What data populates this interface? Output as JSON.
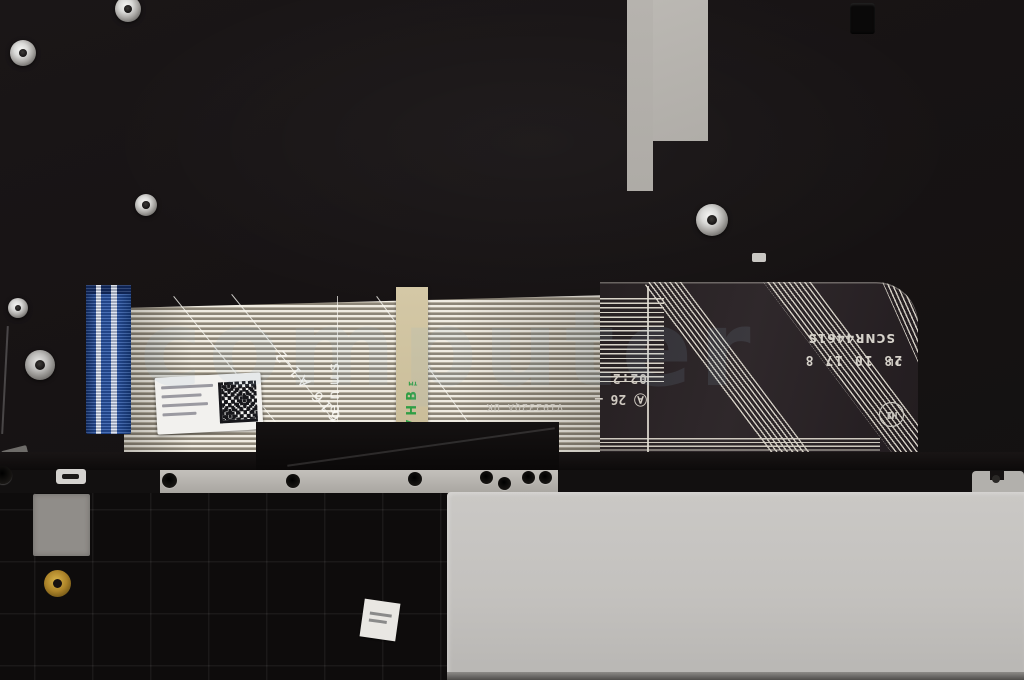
{
  "photo": {
    "title": "Laptop palmrest internal assembly with keyboard membrane, ribbon cable and touchpad",
    "watermark": "computer"
  },
  "membrane": {
    "serial": "SCNR4461S",
    "date_prefix": "JL",
    "date_stamp": "28 10 17 8",
    "model_code": "V19232QA UK",
    "diagonal_mark": "616 A1-2",
    "codename": "venus",
    "tape_brand": "VHB™",
    "stamp_row1": "02:2",
    "stamp_row2": "Ⓐ 26 —",
    "cert_marks": [
      "H1",
      "O"
    ]
  },
  "colors": {
    "cable_blue": "#2b57a8",
    "tape_green": "#2f9e44",
    "touchpad_gray": "#c6c4c1",
    "chassis_black": "#141111"
  }
}
